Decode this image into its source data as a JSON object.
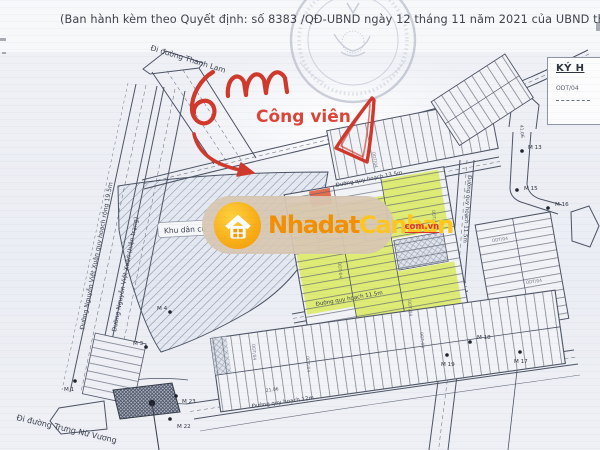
{
  "document": {
    "header": "(Ban hành kèm theo Quyết định: số 8383 /QĐ-UBND ngày 12 tháng 11 năm 2021 của UBND thị xã"
  },
  "legend": {
    "title": "KÝ H",
    "code": "ODT/04"
  },
  "annotations": {
    "handwriting": "6m",
    "park_label": "Công viên",
    "ink_color": "#cf382b"
  },
  "watermark": {
    "brand_part1": "Nhadat",
    "brand_part2": "Canban",
    "domain": "com.vn"
  },
  "map": {
    "area_label": "Khu dân cư",
    "plot_code": "ODT/04",
    "roads": {
      "thanh_lam": "Đi đường Thanh Lam",
      "nguyen_viet_xuan_qh": "Đường Nguyễn Việt Xuân quy hoạch rộng 19.5m",
      "nguyen_viet_xuan_ht": "Đường Nguyễn Việt Xuân (hiện trạng)",
      "trung_nu_vuong": "Đi đường Trưng Nữ Vương",
      "qh_13_5": "Đường quy hoạch 13.5m",
      "qh_11_5": "Đường quy hoạch 11.5m",
      "qh_12": "Đường quy hoạch 12m"
    },
    "markers": {
      "m1": "M 1",
      "m3": "M 3",
      "m4": "M 4",
      "m13": "M 13",
      "m15": "M 15",
      "m16": "M 16",
      "m17": "M 17",
      "m18": "M 18",
      "m19": "M 19",
      "m22": "M 22",
      "m23": "M 23"
    },
    "dims": {
      "d1": "41.06",
      "d2": "21.06"
    }
  },
  "colors": {
    "highlight_plot": "#dcea6e",
    "map_line": "#4b5364",
    "watermark_bg": "#d8c7b3"
  }
}
